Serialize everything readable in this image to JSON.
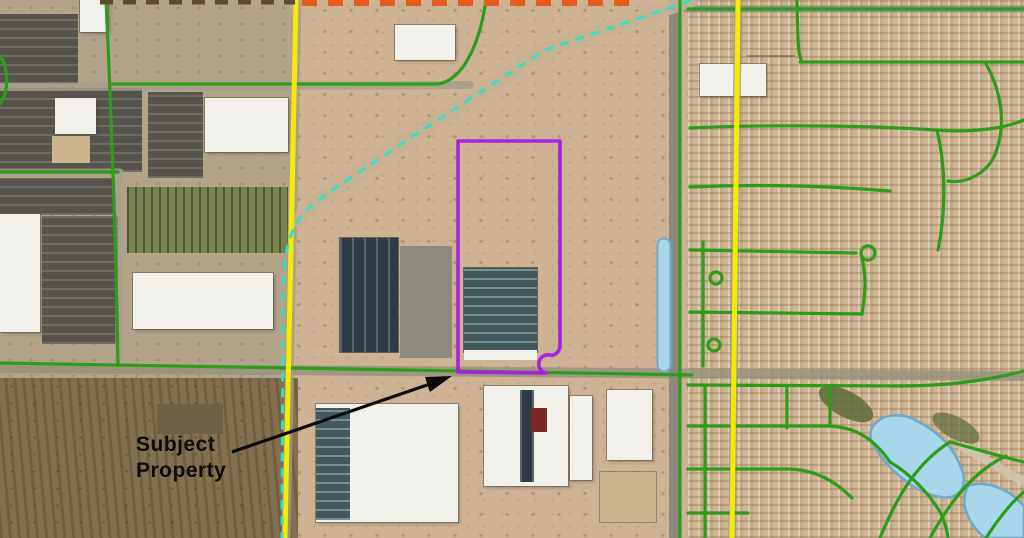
{
  "map": {
    "type": "aerial-property-exhibit",
    "annotation": {
      "line1": "Subject",
      "line2": "Property"
    },
    "colors": {
      "subject_boundary": "#AB1FE0",
      "section_line": "#F6EA00",
      "street_overlay": "#2E9C1B",
      "north_boundary_dash": "#E65A1C",
      "west_boundary_dash": "#61492F",
      "trail_dash": "#35DCC8",
      "water": "#A8D6EA",
      "water_edge": "#6FA8C8",
      "arrow": "#0A0A0A"
    }
  }
}
